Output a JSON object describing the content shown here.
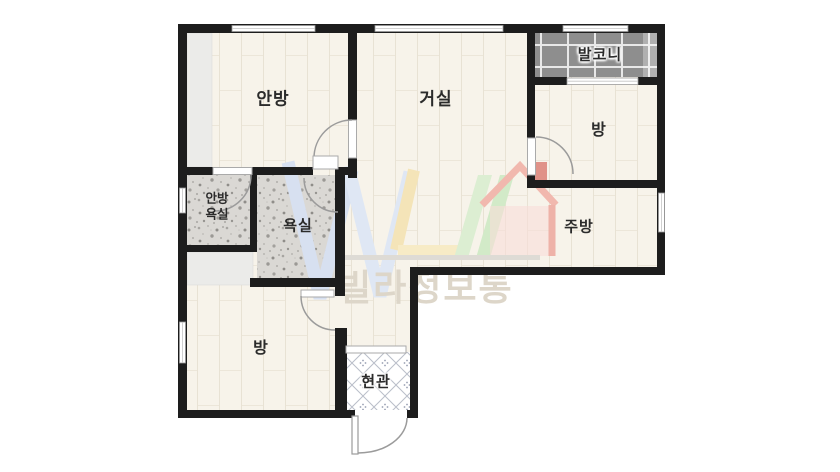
{
  "plan": {
    "rooms": [
      {
        "id": "master-bedroom",
        "label": "안방"
      },
      {
        "id": "living-room",
        "label": "거실"
      },
      {
        "id": "balcony",
        "label": "발코니"
      },
      {
        "id": "room-upper",
        "label": "방"
      },
      {
        "id": "master-bathroom",
        "label_line1": "안방",
        "label_line2": "욕실"
      },
      {
        "id": "bathroom",
        "label": "욕실"
      },
      {
        "id": "kitchen",
        "label": "주방"
      },
      {
        "id": "room-lower",
        "label": "방"
      },
      {
        "id": "entrance",
        "label": "현관"
      }
    ]
  },
  "watermark": {
    "brand_text": "빌라정보통"
  },
  "colors": {
    "wall": "#1d1d1d",
    "floor": "#f7f3ea",
    "floor_line": "#e8e2d4",
    "closet": "#ebebe9",
    "bathroom_tile_base": "#dad8d4",
    "balcony_tile": "#8e8e8e",
    "entry_lattice": "#b9bec9",
    "door_arc": "#9b9b9b",
    "label_text": "#2b2b2b",
    "watermark_text": "#ddd6c9",
    "watermark_blue": "#d7e0f0",
    "watermark_yellow": "#f4e4b8",
    "watermark_green": "#d5ebca",
    "watermark_red": "#f1b8ae"
  }
}
